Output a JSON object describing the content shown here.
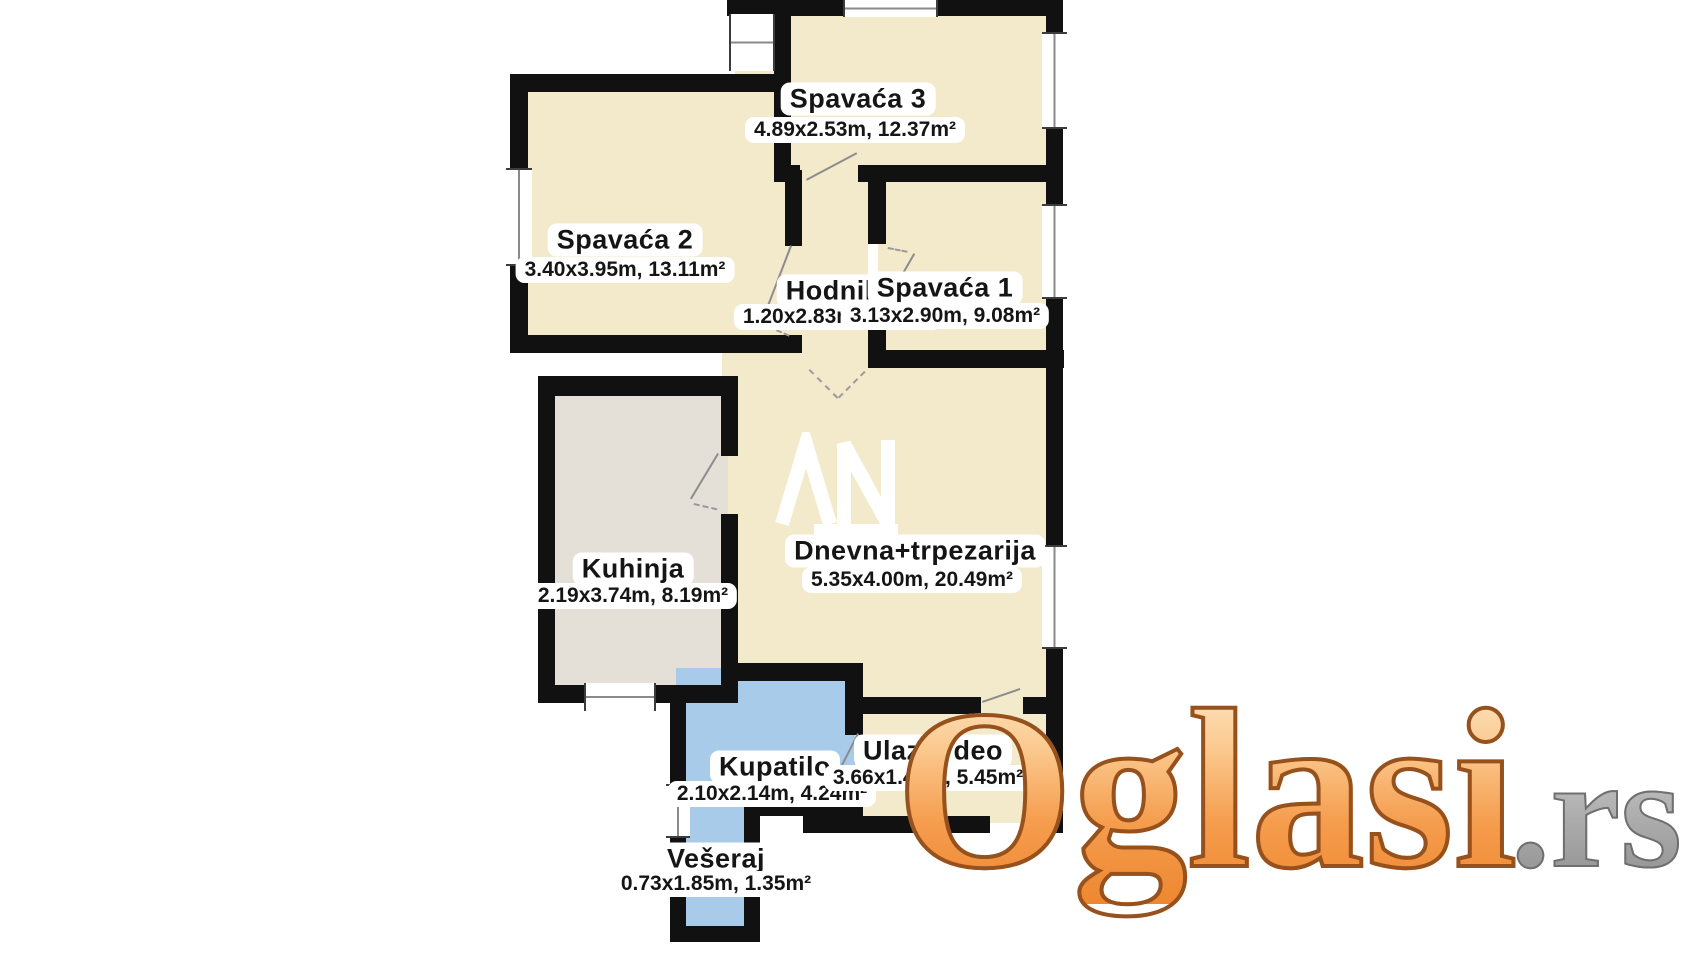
{
  "page": {
    "background": "#ffffff",
    "type": "apartment floor plan"
  },
  "brand": {
    "word": "Oglasi",
    "tld": ".rs"
  },
  "agency_watermark": "AN",
  "rooms": [
    {
      "name": "Spavaća 3",
      "dims": "4.89x2.53m, 12.37m²"
    },
    {
      "name": "Spavaća 2",
      "dims": "3.40x3.95m, 13.11m²"
    },
    {
      "name": "Hodnik",
      "dims": "1.20x2.83m, 3.40m²"
    },
    {
      "name": "Spavaća 1",
      "dims": "3.13x2.90m, 9.08m²"
    },
    {
      "name": "Kuhinja",
      "dims": "2.19x3.74m, 8.19m²"
    },
    {
      "name": "Dnevna+trpezarija",
      "dims": "5.35x4.00m, 20.49m²"
    },
    {
      "name": "Kupatilo",
      "dims": "2.10x2.14m, 4.24m²"
    },
    {
      "name": "Ulazni deo",
      "dims": "3.66x1.49m, 5.45m²"
    },
    {
      "name": "Vešeraj",
      "dims": "0.73x1.85m, 1.35m²"
    }
  ],
  "colors": {
    "room_fill": "#f3e9cb",
    "kitchen_fill": "#e4e0d8",
    "bathroom_fill": "#a7cbe9",
    "wall": "#111111",
    "logo_orange": "#f59d4e",
    "logo_outline": "#96511d",
    "logo_tld_gray": "#9c9c9c"
  }
}
